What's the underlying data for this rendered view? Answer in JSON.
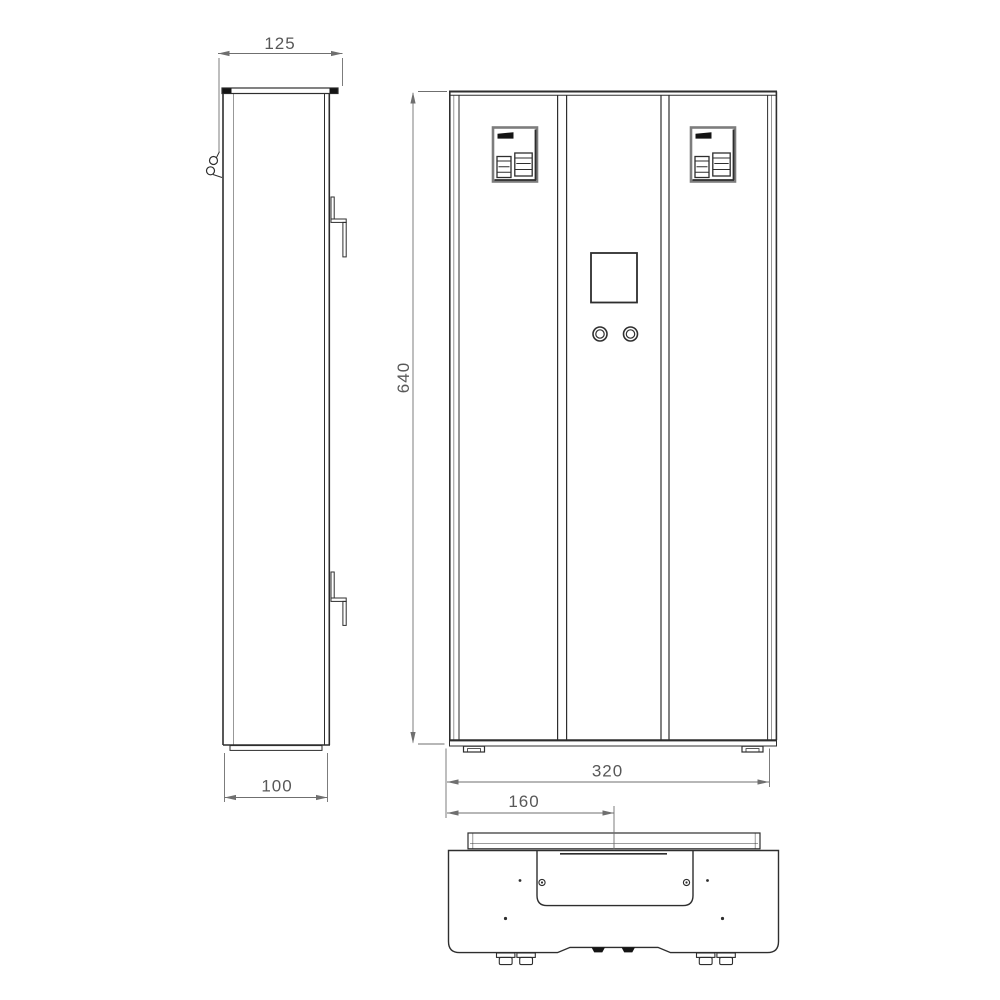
{
  "dimensions": {
    "d125": "125",
    "d640": "640",
    "d320": "320",
    "d100": "100",
    "d160": "160"
  },
  "colors": {
    "background": "#ffffff",
    "line": "#2e2e2e",
    "frame_gray": "#7d7d7d",
    "fill_dark": "#141414",
    "dim_line": "#6f6f6f",
    "dim_text": "#585858"
  }
}
